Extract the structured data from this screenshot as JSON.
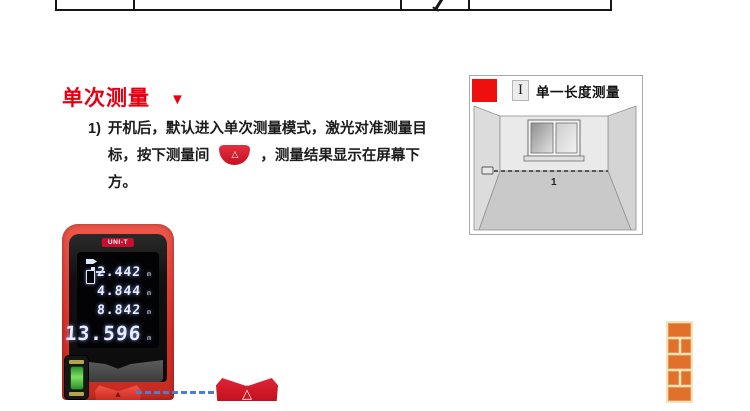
{
  "colors": {
    "accent_red": "#e60012",
    "device_red": "#d93228",
    "laser_blue": "#4a7fd0",
    "brick_orange": "#e1702b",
    "screen_digit": "#e8ecff"
  },
  "icons": {
    "table_mark": "diagonal-stroke",
    "heading_marker": "triangle-down",
    "measure_button": "triangle-outline",
    "laser_status": "laser-pointer",
    "reference_point": "device-rear-reference"
  },
  "section": {
    "title": "单次测量",
    "marker": "▼"
  },
  "instruction": {
    "number": "1)",
    "line1": "开机后，默认进入单次测量模式，激光对准测量目",
    "line2_before": "标，按下测量间",
    "line2_after": "，测量结果显示在屏幕下方。",
    "button_glyph": "△"
  },
  "device": {
    "brand": "UNI-T",
    "readings": [
      {
        "value": "2.442",
        "unit": "m"
      },
      {
        "value": "4.844",
        "unit": "m"
      },
      {
        "value": "8.842",
        "unit": "m"
      },
      {
        "value": "13.596",
        "unit": "m"
      }
    ],
    "button_glyph": "▲"
  },
  "callout": {
    "button_glyph": "△"
  },
  "diagram": {
    "icon_glyph": "I",
    "title": "单一长度测量",
    "measure_label": "1"
  }
}
